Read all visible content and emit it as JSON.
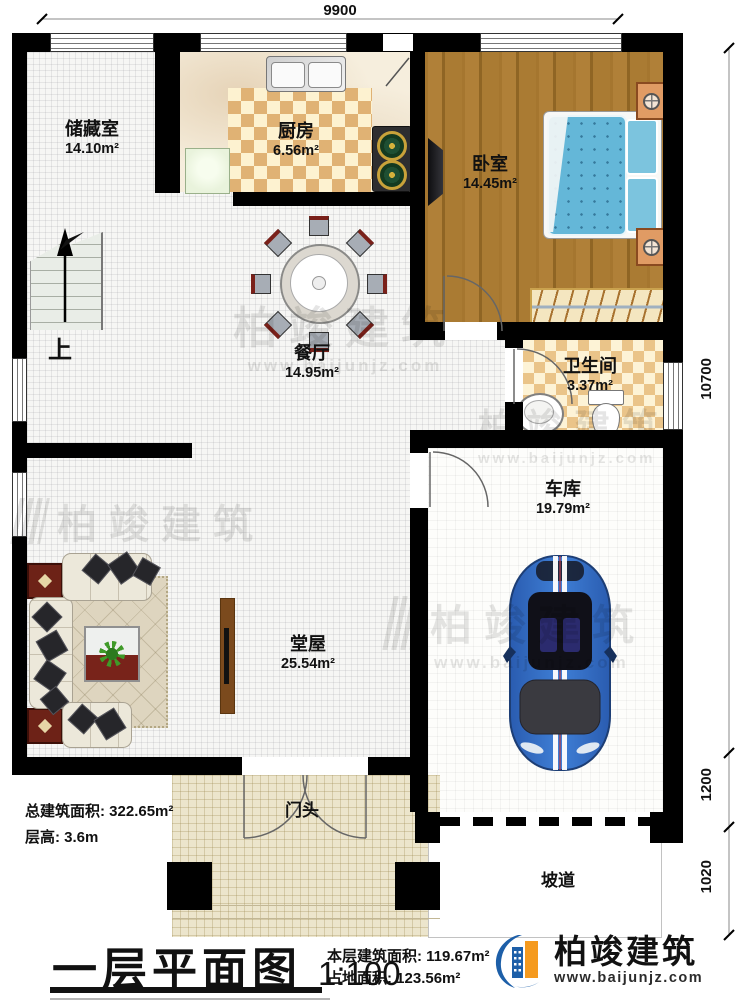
{
  "dim_top": "9900",
  "dim_right": {
    "total": "10700",
    "garage_front": "1200",
    "ramp": "1020"
  },
  "rooms": {
    "storage": {
      "name": "储藏室",
      "area": "14.10m²"
    },
    "kitchen": {
      "name": "厨房",
      "area": "6.56m²"
    },
    "bedroom": {
      "name": "卧室",
      "area": "14.45m²"
    },
    "dining": {
      "name": "餐厅",
      "area": "14.95m²"
    },
    "bathroom": {
      "name": "卫生间",
      "area": "3.37m²"
    },
    "garage": {
      "name": "车库",
      "area": "19.79m²"
    },
    "hall": {
      "name": "堂屋",
      "area": "25.54m²"
    },
    "porch": {
      "name": "门头"
    },
    "ramp": {
      "name": "坡道"
    }
  },
  "stairs_up": "上",
  "notes": {
    "total_area": "总建筑面积: 322.65m²",
    "floor_height": "层高: 3.6m"
  },
  "titleblock": {
    "title": "一层平面图",
    "scale": "1:100",
    "floor_area": "本层建筑面积: 119.67m²",
    "footprint": "占地面积: 123.56m²"
  },
  "brand": {
    "name": "柏竣建筑",
    "site": "www.baijunjz.com"
  },
  "colors": {
    "wall": "#000000",
    "wood": "#a5762f",
    "bed": "#64b7d8",
    "car": "#2f6bc4",
    "brand_blue": "#1d5fa8",
    "brand_orange": "#f59a1e"
  }
}
